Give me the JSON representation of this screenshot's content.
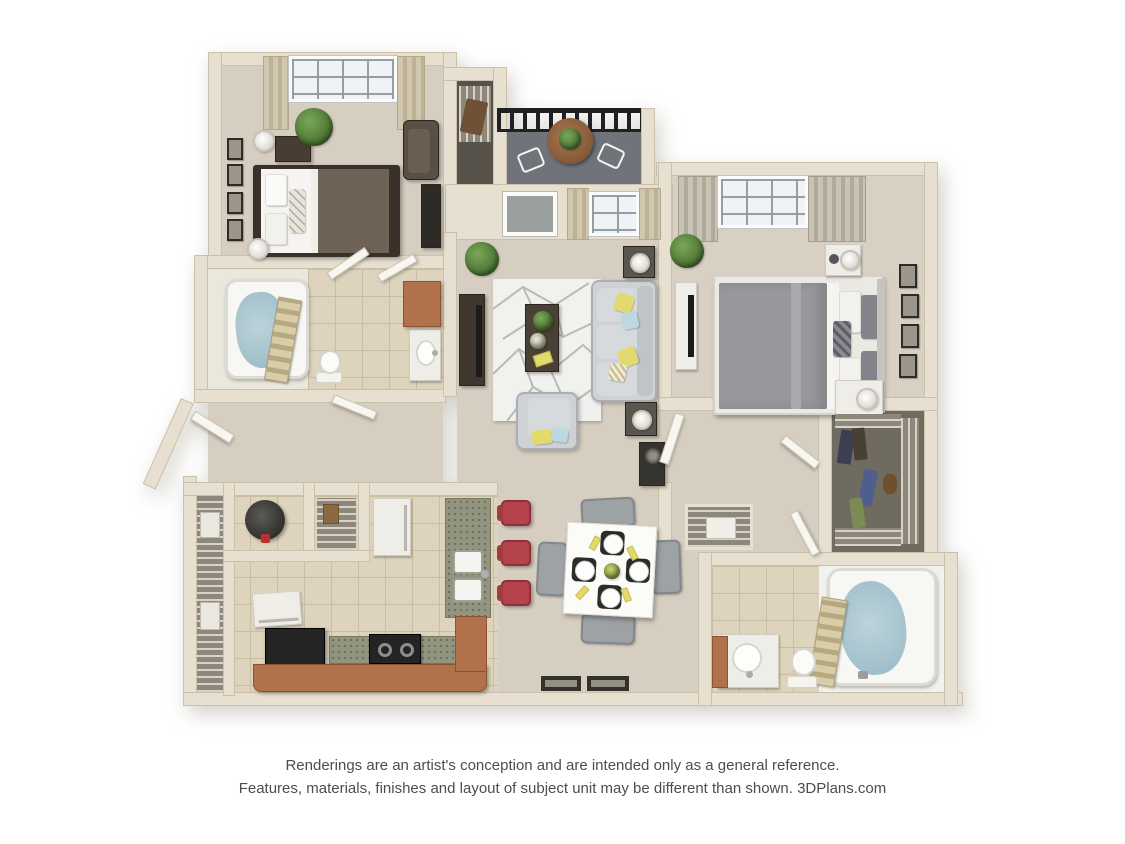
{
  "page": {
    "disclaimer_line1": "Renderings are an artist's conception and are intended only as a general reference.",
    "disclaimer_line2": "Features, materials, finishes and layout of subject unit may be different than shown. 3DPlans.com"
  },
  "plan": {
    "type": "3d-floor-plan-rendering",
    "rooms": [
      "bedroom-1",
      "bathroom-1",
      "storage-closet",
      "balcony",
      "living-room",
      "bedroom-2",
      "walk-in-closet",
      "bathroom-2",
      "kitchen",
      "dining-area",
      "laundry-closet",
      "entry",
      "hallway"
    ]
  },
  "palette": {
    "wall": "#e7dfcf",
    "wall-edge": "#cbc1ab",
    "carpet": "#d6cec0",
    "tile": "#ded4bd",
    "tile-line": "#c9bda2",
    "balcony": "#70747a",
    "railing": "#1e2023",
    "rug": "#f1f1ee",
    "rug-line": "#b7babb",
    "sofa": "#ced2d5",
    "sofa-edge": "#a9afb3",
    "pillow-yellow": "#e3da6e",
    "pillow-blue": "#bdd8e0",
    "wood-dark": "#473d33",
    "tv": "#1b1b1b",
    "bed1-blanket": "#6e6356",
    "bed2-comforter": "#98979b",
    "white-linen": "#f5f4f0",
    "plant": "#466d2e",
    "granite": "#92947f",
    "granite-dot": "#6d7059",
    "counter-brown": "#b0714b",
    "stool-red": "#b5434c",
    "water": "#9fbeca",
    "curtain-tan": "#d0c7ae",
    "curtain-tan2": "#bdb293",
    "curtain-gray": "#c8c3b6",
    "curtain-gray2": "#b0aa99",
    "closet-floor": "#6f6b61",
    "wire": "#8d887b",
    "door-white": "#f8f6f1",
    "appliance-black": "#242424",
    "text": "#4d4d4d",
    "background": "#ffffff"
  }
}
